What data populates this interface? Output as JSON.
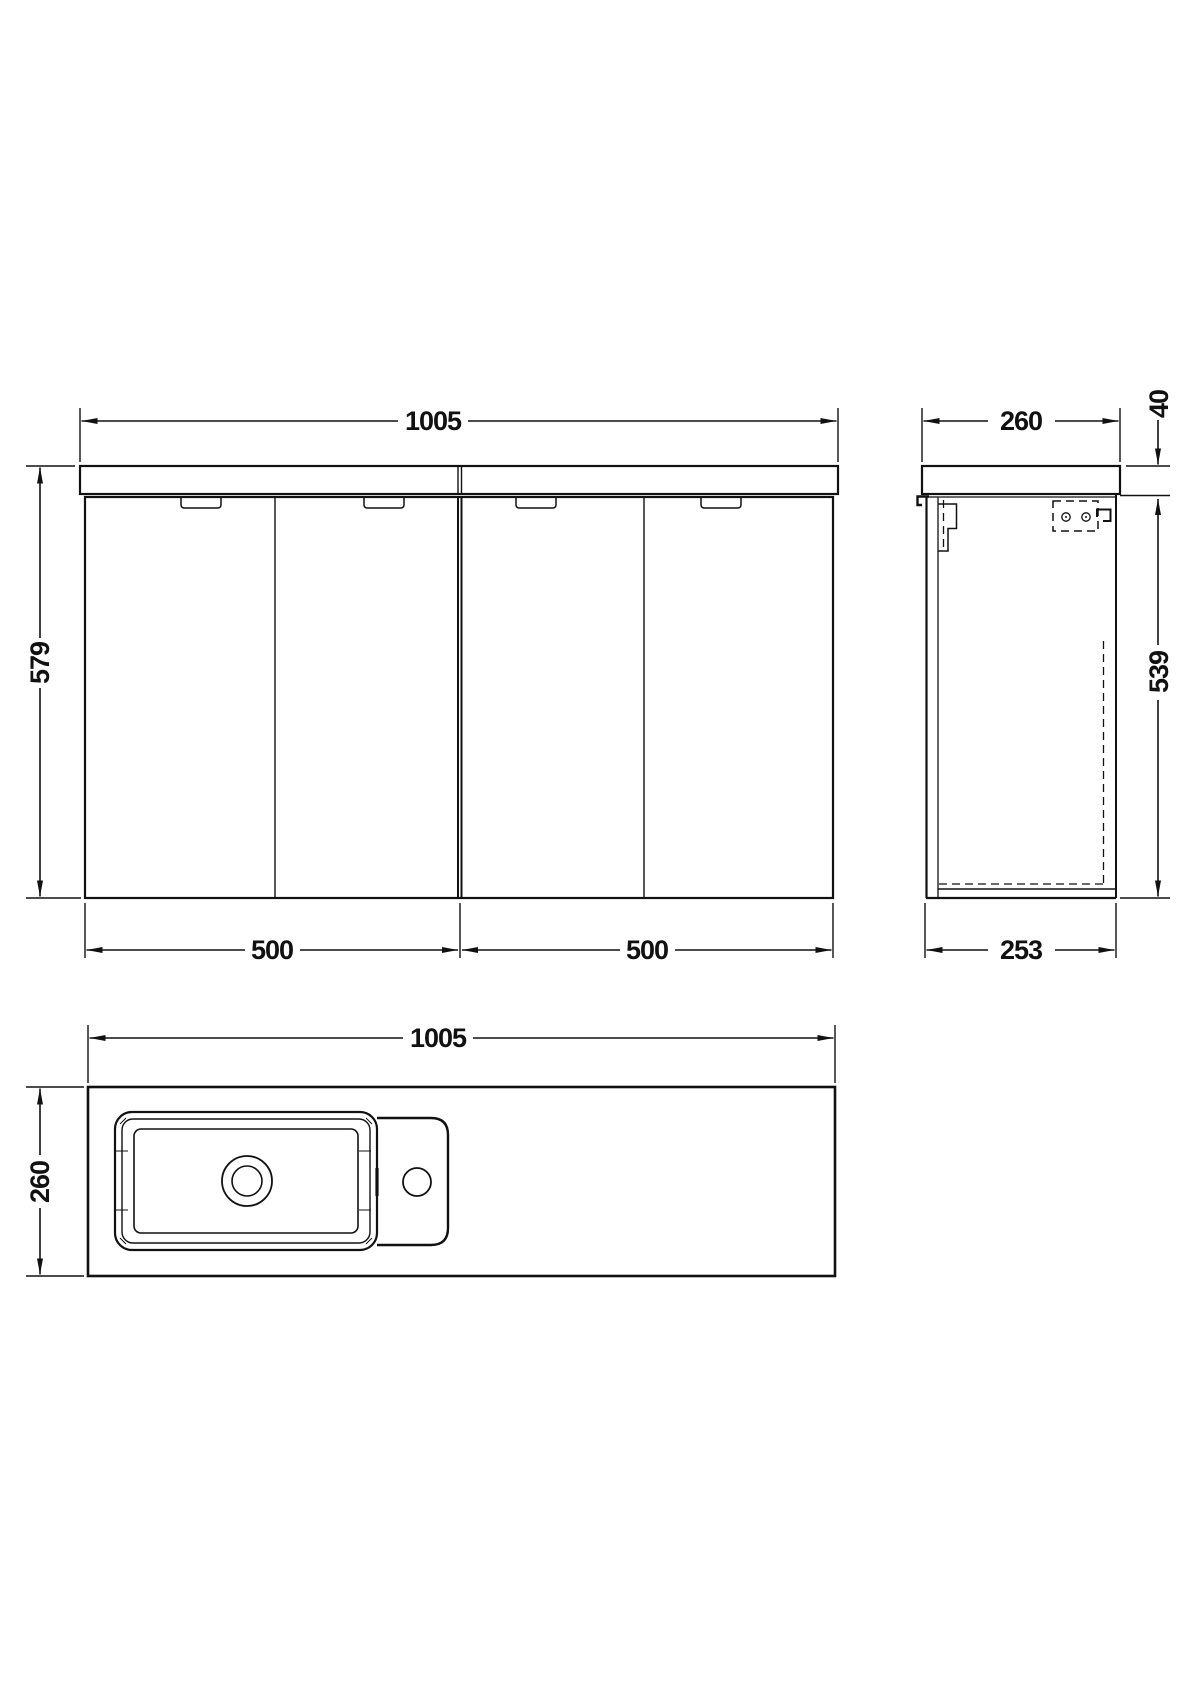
{
  "drawing": {
    "background": "#ffffff",
    "line_color": "#111111",
    "views": {
      "front": {
        "name": "front-elevation",
        "dims": {
          "width": "1005",
          "height": "579",
          "unit_left": "500",
          "unit_right": "500"
        }
      },
      "side": {
        "name": "side-elevation",
        "dims": {
          "depth": "260",
          "counter_thickness": "40",
          "cabinet_height": "539",
          "cabinet_depth": "253"
        }
      },
      "plan": {
        "name": "plan-view",
        "dims": {
          "width": "1005",
          "depth": "260"
        }
      }
    }
  }
}
